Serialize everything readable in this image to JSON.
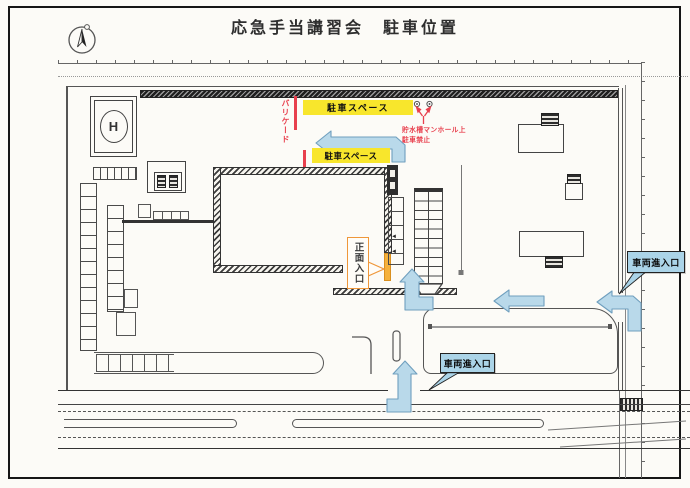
{
  "page": {
    "title": "応急手当講習会　駐車位置"
  },
  "icons": {
    "compass": "north-arrow",
    "stair_arrow": "◄"
  },
  "colors": {
    "parking_yellow": "#f8e62c",
    "warning_red": "#e8404e",
    "entrance_orange": "#ef973a",
    "entrance_door": "#f5b13c",
    "route_blue_fill": "#b9d9ea",
    "route_blue_edge": "#6f9fbe",
    "callout_blue_bg": "#abd4e8",
    "line_dark": "#444444"
  },
  "map": {
    "helipad_label": "H",
    "parking_bars": [
      {
        "label": "駐車スペース"
      },
      {
        "label": "駐車スペース"
      }
    ],
    "barricade_label": "バリケード",
    "manhole_warning": {
      "line1": "貯水槽マンホール上",
      "line2": "駐車禁止"
    },
    "main_entrance_label": "正面入口",
    "vehicle_entrances": [
      {
        "label": "車両進入口"
      },
      {
        "label": "車両進入口"
      }
    ]
  }
}
